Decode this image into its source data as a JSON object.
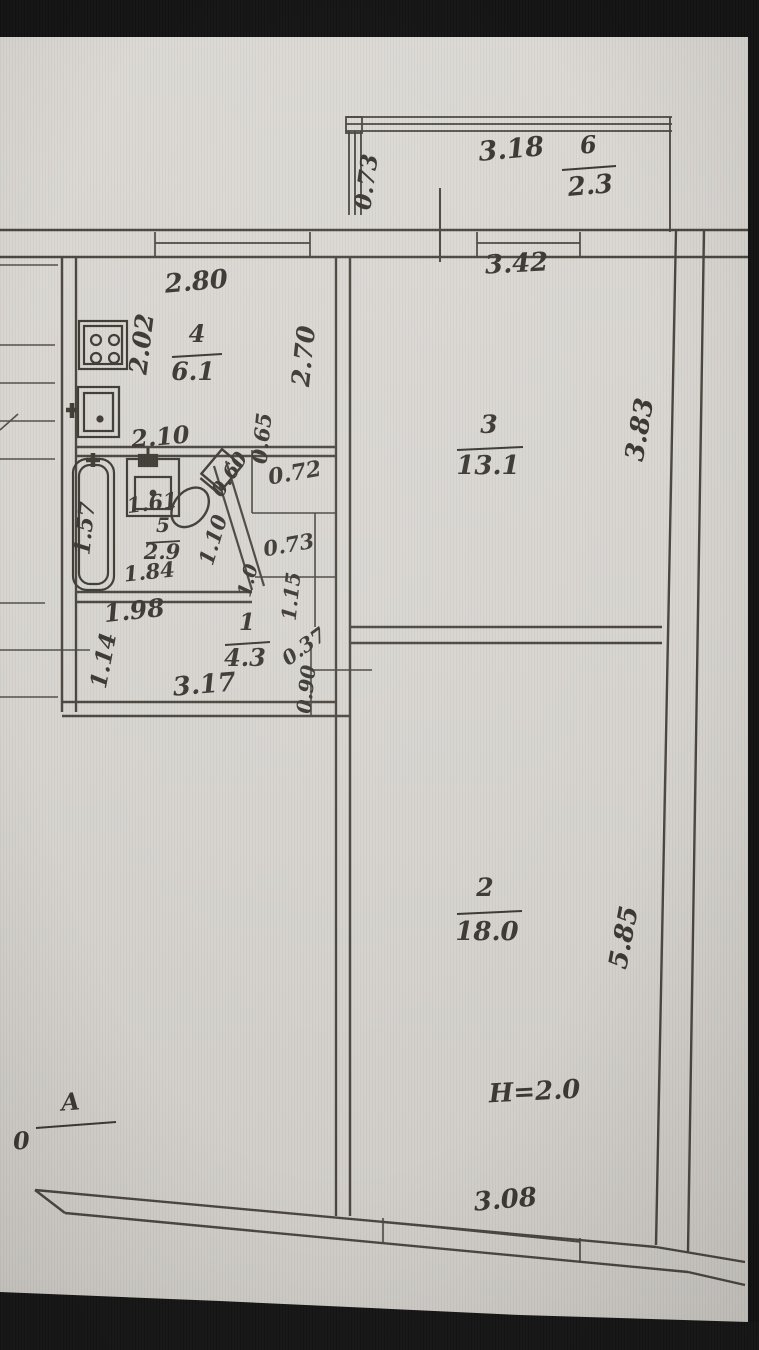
{
  "photo": {
    "background_color": "#141414",
    "paper_color": "#d8d5d0",
    "ink_color": "#4a463f"
  },
  "balcony": {
    "number": "6",
    "area": "2.3",
    "width": "3.18",
    "depth": "0.73"
  },
  "room3": {
    "number": "3",
    "area": "13.1",
    "top": "3.42",
    "right": "3.83",
    "left_wall": "2.70"
  },
  "kitchen": {
    "number": "4",
    "area": "6.1",
    "top": "2.80",
    "left": "2.02",
    "bottom": "2.10"
  },
  "bathroom": {
    "number": "5",
    "area": "2.9",
    "tub": "1.57",
    "basin": "1.61",
    "diag_top": "0.60",
    "diag_wall": "1.10",
    "diag_low": "1.0",
    "bottom": "1.84"
  },
  "shaft": {
    "height": "0.65",
    "width": "0.72",
    "lower_width": "0.73",
    "lower_height": "1.15"
  },
  "hall": {
    "number": "1",
    "area": "4.3",
    "top": "1.98",
    "left": "1.14",
    "bottom": "3.17",
    "niche_width": "0.37",
    "niche_height": "0.90"
  },
  "room2": {
    "number": "2",
    "area": "18.0",
    "right": "5.85",
    "height_note": "H=2.0",
    "bottom": "3.08"
  },
  "axis": {
    "letter": "A",
    "below": "0"
  }
}
